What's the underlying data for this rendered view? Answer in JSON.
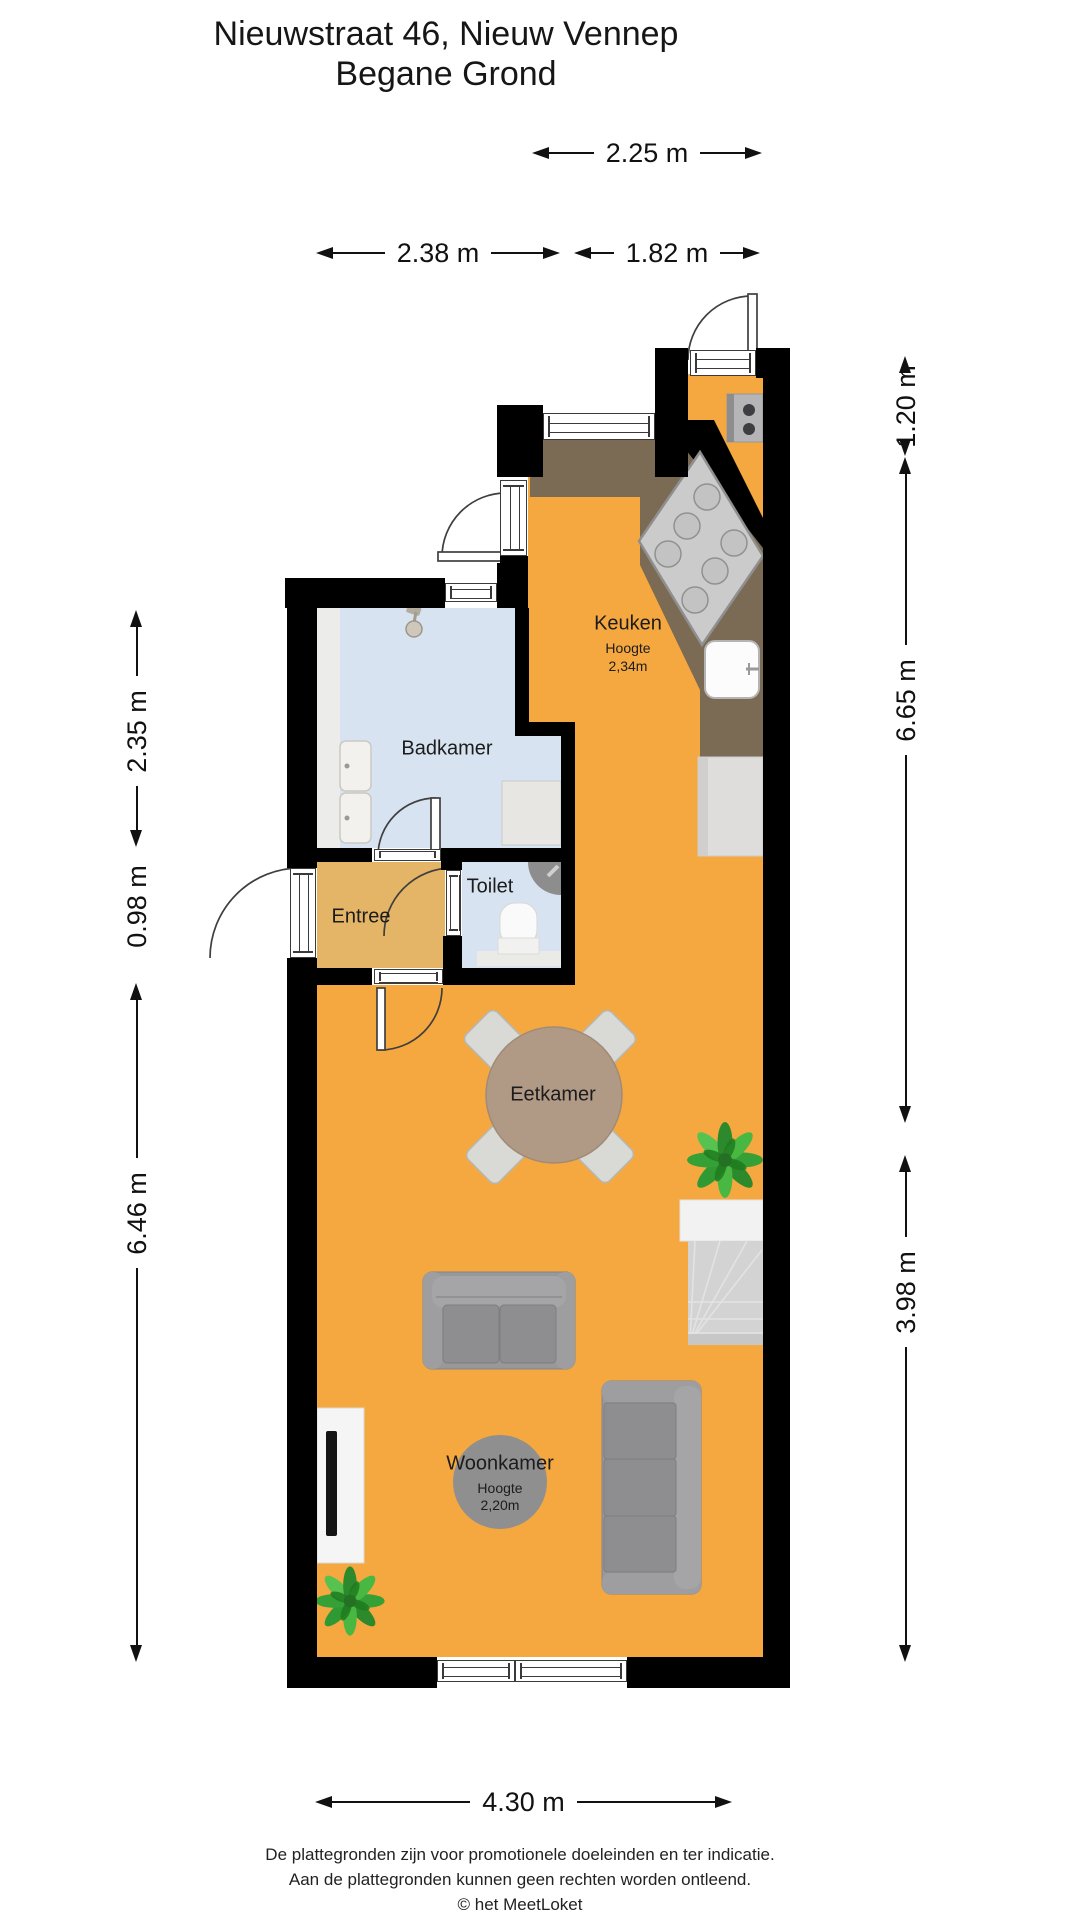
{
  "title": {
    "line1": "Nieuwstraat 46, Nieuw Vennep",
    "line2": "Begane Grond"
  },
  "rooms": {
    "keuken": {
      "label": "Keuken",
      "height_caption": "Hoogte",
      "height_value": "2,34m"
    },
    "badkamer": {
      "label": "Badkamer"
    },
    "toilet": {
      "label": "Toilet"
    },
    "entree": {
      "label": "Entree"
    },
    "eetkamer": {
      "label": "Eetkamer"
    },
    "woonkamer": {
      "label": "Woonkamer",
      "height_caption": "Hoogte",
      "height_value": "2,20m"
    }
  },
  "dimensions": {
    "top_width": "2.25 m",
    "top_left_width": "2.38 m",
    "top_right_width": "1.82 m",
    "right_top": "1.20 m",
    "right_middle": "6.65 m",
    "right_bottom": "3.98 m",
    "left_top": "2.35 m",
    "left_middle": "0.98 m",
    "left_bottom": "6.46 m",
    "bottom_width": "4.30 m"
  },
  "footer": {
    "line1": "De plattegronden zijn voor promotionele doeleinden en ter indicatie.",
    "line2": "Aan de plattegronden kunnen geen rechten worden ontleend.",
    "line3": "© het MeetLoket"
  },
  "colors": {
    "floor_orange": "#F6A840",
    "floor_entree": "#E4B566",
    "floor_bathroom": "#D7E3F1",
    "counter_brown": "#7C6B54",
    "wall_black": "#000000",
    "furniture_gray": "#98989B",
    "stairs_gray": "#D3D3D3",
    "table_brown": "#B09A85",
    "rug_gray": "#8F8F8F",
    "plant_green": "#35A035"
  }
}
